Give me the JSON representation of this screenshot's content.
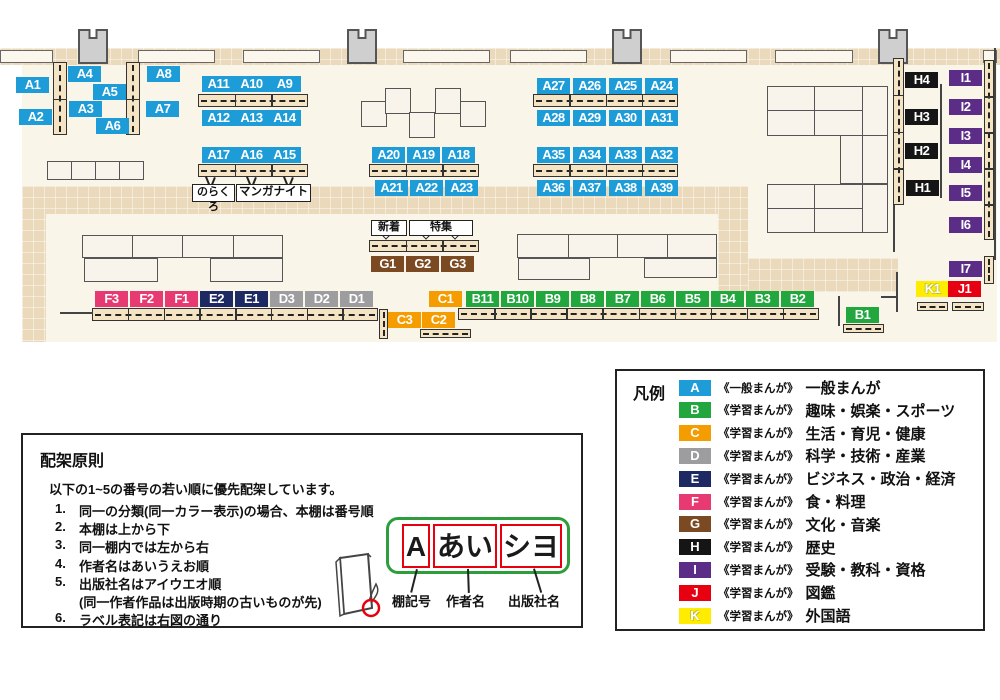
{
  "map": {
    "category_colors": {
      "A": "#1E9CD7",
      "B": "#21A73E",
      "C": "#F59C00",
      "D": "#9D9DA0",
      "E": "#1D2963",
      "F": "#E73972",
      "G": "#7B4A23",
      "H": "#151515",
      "I": "#5B2D87",
      "J": "#E60012",
      "K": "#FFEC00"
    },
    "shelf_labels": [
      {
        "id": "A1",
        "cat": "A",
        "x": 16,
        "y": 77
      },
      {
        "id": "A2",
        "cat": "A",
        "x": 19,
        "y": 109
      },
      {
        "id": "A4",
        "cat": "A",
        "x": 68,
        "y": 66
      },
      {
        "id": "A5",
        "cat": "A",
        "x": 93,
        "y": 84
      },
      {
        "id": "A3",
        "cat": "A",
        "x": 69,
        "y": 101
      },
      {
        "id": "A6",
        "cat": "A",
        "x": 96,
        "y": 118
      },
      {
        "id": "A8",
        "cat": "A",
        "x": 147,
        "y": 66
      },
      {
        "id": "A7",
        "cat": "A",
        "x": 146,
        "y": 101
      },
      {
        "id": "A11",
        "cat": "A",
        "x": 202,
        "y": 76
      },
      {
        "id": "A10",
        "cat": "A",
        "x": 235,
        "y": 76
      },
      {
        "id": "A9",
        "cat": "A",
        "x": 268,
        "y": 76
      },
      {
        "id": "A12",
        "cat": "A",
        "x": 202,
        "y": 110
      },
      {
        "id": "A13",
        "cat": "A",
        "x": 235,
        "y": 110
      },
      {
        "id": "A14",
        "cat": "A",
        "x": 268,
        "y": 110
      },
      {
        "id": "A17",
        "cat": "A",
        "x": 202,
        "y": 147
      },
      {
        "id": "A16",
        "cat": "A",
        "x": 235,
        "y": 147
      },
      {
        "id": "A15",
        "cat": "A",
        "x": 268,
        "y": 147
      },
      {
        "id": "A20",
        "cat": "A",
        "x": 372,
        "y": 147
      },
      {
        "id": "A19",
        "cat": "A",
        "x": 407,
        "y": 147
      },
      {
        "id": "A18",
        "cat": "A",
        "x": 442,
        "y": 147
      },
      {
        "id": "A21",
        "cat": "A",
        "x": 375,
        "y": 180
      },
      {
        "id": "A22",
        "cat": "A",
        "x": 410,
        "y": 180
      },
      {
        "id": "A23",
        "cat": "A",
        "x": 445,
        "y": 180
      },
      {
        "id": "A27",
        "cat": "A",
        "x": 537,
        "y": 78
      },
      {
        "id": "A26",
        "cat": "A",
        "x": 573,
        "y": 78
      },
      {
        "id": "A25",
        "cat": "A",
        "x": 609,
        "y": 78
      },
      {
        "id": "A24",
        "cat": "A",
        "x": 645,
        "y": 78
      },
      {
        "id": "A28",
        "cat": "A",
        "x": 537,
        "y": 110
      },
      {
        "id": "A29",
        "cat": "A",
        "x": 573,
        "y": 110
      },
      {
        "id": "A30",
        "cat": "A",
        "x": 609,
        "y": 110
      },
      {
        "id": "A31",
        "cat": "A",
        "x": 645,
        "y": 110
      },
      {
        "id": "A35",
        "cat": "A",
        "x": 537,
        "y": 147
      },
      {
        "id": "A34",
        "cat": "A",
        "x": 573,
        "y": 147
      },
      {
        "id": "A33",
        "cat": "A",
        "x": 609,
        "y": 147
      },
      {
        "id": "A32",
        "cat": "A",
        "x": 645,
        "y": 147
      },
      {
        "id": "A36",
        "cat": "A",
        "x": 537,
        "y": 180
      },
      {
        "id": "A37",
        "cat": "A",
        "x": 573,
        "y": 180
      },
      {
        "id": "A38",
        "cat": "A",
        "x": 609,
        "y": 180
      },
      {
        "id": "A39",
        "cat": "A",
        "x": 645,
        "y": 180
      },
      {
        "id": "G1",
        "cat": "G",
        "x": 371,
        "y": 256
      },
      {
        "id": "G2",
        "cat": "G",
        "x": 406,
        "y": 256
      },
      {
        "id": "G3",
        "cat": "G",
        "x": 441,
        "y": 256
      },
      {
        "id": "F3",
        "cat": "F",
        "x": 95,
        "y": 291
      },
      {
        "id": "F2",
        "cat": "F",
        "x": 130,
        "y": 291
      },
      {
        "id": "F1",
        "cat": "F",
        "x": 165,
        "y": 291
      },
      {
        "id": "E2",
        "cat": "E",
        "x": 200,
        "y": 291
      },
      {
        "id": "E1",
        "cat": "E",
        "x": 235,
        "y": 291
      },
      {
        "id": "D3",
        "cat": "D",
        "x": 270,
        "y": 291
      },
      {
        "id": "D2",
        "cat": "D",
        "x": 305,
        "y": 291
      },
      {
        "id": "D1",
        "cat": "D",
        "x": 340,
        "y": 291
      },
      {
        "id": "C1",
        "cat": "C",
        "x": 429,
        "y": 291
      },
      {
        "id": "B11",
        "cat": "B",
        "x": 466,
        "y": 291
      },
      {
        "id": "B10",
        "cat": "B",
        "x": 501,
        "y": 291
      },
      {
        "id": "B9",
        "cat": "B",
        "x": 536,
        "y": 291
      },
      {
        "id": "B8",
        "cat": "B",
        "x": 571,
        "y": 291
      },
      {
        "id": "B7",
        "cat": "B",
        "x": 606,
        "y": 291
      },
      {
        "id": "B6",
        "cat": "B",
        "x": 641,
        "y": 291
      },
      {
        "id": "B5",
        "cat": "B",
        "x": 676,
        "y": 291
      },
      {
        "id": "B4",
        "cat": "B",
        "x": 711,
        "y": 291
      },
      {
        "id": "B3",
        "cat": "B",
        "x": 746,
        "y": 291
      },
      {
        "id": "B2",
        "cat": "B",
        "x": 781,
        "y": 291
      },
      {
        "id": "C3",
        "cat": "C",
        "x": 388,
        "y": 312
      },
      {
        "id": "C2",
        "cat": "C",
        "x": 422,
        "y": 312
      },
      {
        "id": "B1",
        "cat": "B",
        "x": 846,
        "y": 307
      },
      {
        "id": "H4",
        "cat": "H",
        "x": 905,
        "y": 72
      },
      {
        "id": "H3",
        "cat": "H",
        "x": 905,
        "y": 109
      },
      {
        "id": "H2",
        "cat": "H",
        "x": 905,
        "y": 143
      },
      {
        "id": "H1",
        "cat": "H",
        "x": 906,
        "y": 180
      },
      {
        "id": "I1",
        "cat": "I",
        "x": 949,
        "y": 70
      },
      {
        "id": "I2",
        "cat": "I",
        "x": 949,
        "y": 99
      },
      {
        "id": "I3",
        "cat": "I",
        "x": 949,
        "y": 128
      },
      {
        "id": "I4",
        "cat": "I",
        "x": 949,
        "y": 157
      },
      {
        "id": "I5",
        "cat": "I",
        "x": 949,
        "y": 185
      },
      {
        "id": "I6",
        "cat": "I",
        "x": 949,
        "y": 217
      },
      {
        "id": "I7",
        "cat": "I",
        "x": 949,
        "y": 261
      },
      {
        "id": "K1",
        "cat": "K",
        "x": 916,
        "y": 281
      },
      {
        "id": "J1",
        "cat": "J",
        "x": 948,
        "y": 281
      }
    ],
    "annotations": {
      "norakuro": "のらくろ",
      "manga_night": "マンガナイト",
      "new_arrivals": "新着",
      "feature": "特集"
    }
  },
  "legend": {
    "title": "凡例",
    "items": [
      {
        "key": "A",
        "color": "#1E9CD7",
        "type": "《一般まんが》",
        "label": "一般まんが"
      },
      {
        "key": "B",
        "color": "#21A73E",
        "type": "《学習まんが》",
        "label": "趣味・娯楽・スポーツ"
      },
      {
        "key": "C",
        "color": "#F59C00",
        "type": "《学習まんが》",
        "label": "生活・育児・健康"
      },
      {
        "key": "D",
        "color": "#9D9DA0",
        "type": "《学習まんが》",
        "label": "科学・技術・産業"
      },
      {
        "key": "E",
        "color": "#1D2963",
        "type": "《学習まんが》",
        "label": "ビジネス・政治・経済"
      },
      {
        "key": "F",
        "color": "#E73972",
        "type": "《学習まんが》",
        "label": "食・料理"
      },
      {
        "key": "G",
        "color": "#7B4A23",
        "type": "《学習まんが》",
        "label": "文化・音楽"
      },
      {
        "key": "H",
        "color": "#151515",
        "type": "《学習まんが》",
        "label": "歴史"
      },
      {
        "key": "I",
        "color": "#5B2D87",
        "type": "《学習まんが》",
        "label": "受験・教科・資格"
      },
      {
        "key": "J",
        "color": "#E60012",
        "type": "《学習まんが》",
        "label": "図鑑"
      },
      {
        "key": "K",
        "color": "#FFEC00",
        "type": "《学習まんが》",
        "label": "外国語"
      }
    ]
  },
  "rules": {
    "title": "配架原則",
    "intro": "以下の1~5の番号の若い順に優先配架しています。",
    "items": [
      {
        "n": "1.",
        "text": "同一の分類(同一カラー表示)の場合、本棚は番号順",
        "note": false
      },
      {
        "n": "2.",
        "text": "本棚は上から下",
        "note": false
      },
      {
        "n": "3.",
        "text": "同一棚内では左から右",
        "note": false
      },
      {
        "n": "4.",
        "text": "作者名はあいうえお順",
        "note": false
      },
      {
        "n": "5.",
        "text": "出版社名はアイウエオ順",
        "note": false
      },
      {
        "n": "",
        "text": "(同一作者作品は出版時期の古いものが先)",
        "note": true
      },
      {
        "n": "6.",
        "text": "ラベル表記は右図の通り",
        "note": false
      }
    ],
    "label_example": {
      "shelf_code": "A",
      "author": "あい",
      "publisher": "シヨ"
    },
    "callouts": [
      {
        "text": "棚記号"
      },
      {
        "text": "作者名"
      },
      {
        "text": "出版社名"
      }
    ]
  }
}
